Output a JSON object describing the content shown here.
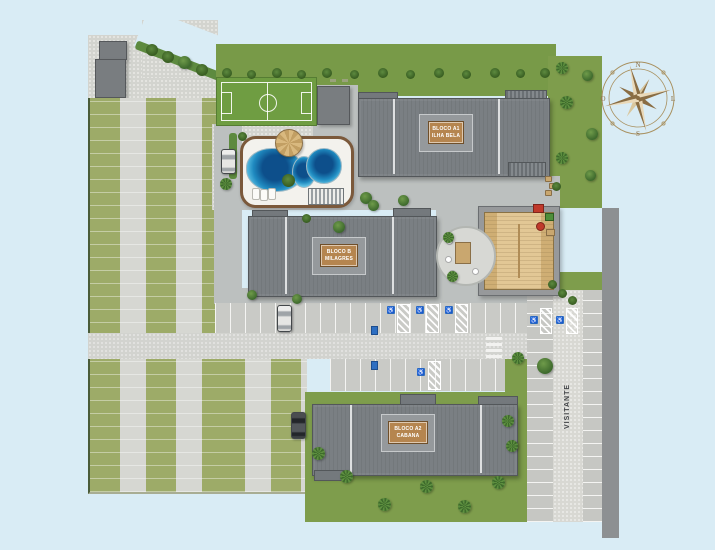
{
  "page": {
    "type": "residential-site-plan"
  },
  "buildings": [
    {
      "id": "bloco-a1",
      "line1": "BLOCO A1",
      "line2": "ILHA BELA"
    },
    {
      "id": "bloco-b",
      "line1": "BLOCO B",
      "line2": "MILAGRES"
    },
    {
      "id": "bloco-a2",
      "line1": "BLOCO A2",
      "line2": "CABANA"
    }
  ],
  "parking": {
    "visitor_label": "VISITANTE"
  },
  "compass": {
    "north": "N",
    "east": "L",
    "south": "S",
    "west": "O"
  },
  "icons": {
    "wheelchair": "♿"
  },
  "colors": {
    "background": "#d9ecf5",
    "lawn": "#7e9d4c",
    "grass_paver": "#9dab68",
    "paving": "#d3d4cf",
    "road_dark": "#8d9092",
    "roof_gray": "#7a7f83",
    "plate_brown": "#b5854f",
    "clubhouse_roof": "#e2c795",
    "pool_blue": "#1a74b0",
    "accessibility_blue": "#2e6fc2"
  }
}
